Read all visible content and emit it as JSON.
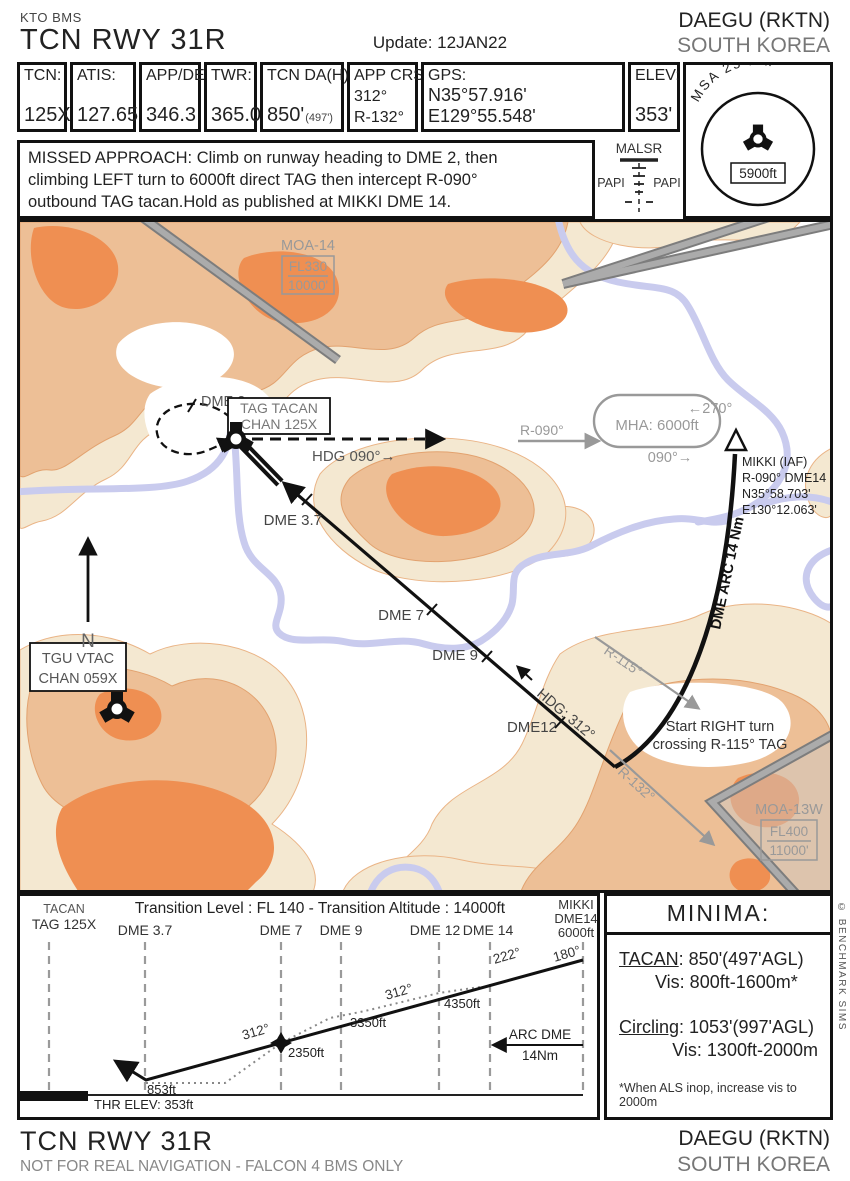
{
  "header": {
    "publisher": "KTO BMS",
    "title": "TCN RWY 31R",
    "update": "Update: 12JAN22",
    "airport": "DAEGU (RKTN)",
    "country": "SOUTH KOREA"
  },
  "databar": {
    "cells": [
      {
        "label": "TCN:",
        "value": "125X"
      },
      {
        "label": "ATIS:",
        "value": "127.65"
      },
      {
        "label": "APP/DEP:",
        "value": "346.3"
      },
      {
        "label": "TWR:",
        "value": "365.0"
      },
      {
        "label": "TCN DA(H):",
        "value": "850'",
        "value_note": "(497')"
      },
      {
        "label": "APP CRS:",
        "line2": "312°",
        "line3": "R-132°"
      },
      {
        "label": "GPS:",
        "line2": "N35°57.916'",
        "line3": "E129°55.548'"
      },
      {
        "label": "ELEV:",
        "value": "353'"
      }
    ]
  },
  "missed_approach": {
    "line1": "MISSED APPROACH: Climb on runway heading to DME 2, then",
    "line2": "climbing LEFT turn to 6000ft direct TAG then intercept R-090°",
    "line3": "outbound TAG tacan.Hold as published at MIKKI DME 14."
  },
  "lighting": {
    "title": "MALSR",
    "papi_left": "PAPI",
    "papi_right": "PAPI"
  },
  "msa": {
    "arc_label": "MSA 25 Nm",
    "altitude": "5900ft"
  },
  "map": {
    "moa14": {
      "name": "MOA-14",
      "upper": "FL330",
      "lower": "10000'"
    },
    "moa13w": {
      "name": "MOA-13W",
      "upper": "FL400",
      "lower": "11000'"
    },
    "dme2": "DME 2",
    "tag_tacan": {
      "line1": "TAG TACAN",
      "line2": "CHAN 125X"
    },
    "hdg090": "HDG 090°→",
    "hdg312": "HDG: 312°",
    "fix_37": "DME 3.7",
    "fix_7": "DME 7",
    "fix_9": "DME 9",
    "fix_12": "DME12",
    "arc_label": "DME ARC 14 Nm",
    "hold": {
      "top": "←270°",
      "mha": "MHA: 6000ft",
      "bottom": "090°→",
      "inbound": "R-090°"
    },
    "mikki": {
      "line1": "MIKKI (IAF)",
      "line2": "R-090° DME14",
      "line3": "N35°58.703'",
      "line4": "E130°12.063'"
    },
    "r115": "R-115°",
    "r132": "R-132°",
    "right_turn": {
      "line1": "Start RIGHT turn",
      "line2": "crossing R-115° TAG"
    },
    "tgu": {
      "line1": "TGU VTAC",
      "line2": "CHAN 059X"
    },
    "north": "N"
  },
  "profile": {
    "tacan_line1": "TACAN",
    "tacan_line2": "TAG 125X",
    "transition": "Transition Level : FL 140  -  Transition Altitude : 14000ft",
    "fixes": [
      "DME 3.7",
      "DME 7",
      "DME 9",
      "DME 12",
      "DME 14"
    ],
    "mikki_line1": "MIKKI",
    "mikki_line2": "DME14",
    "mikki_line3": "6000ft",
    "crs_180": "180°",
    "crs_222": "222°",
    "crs_312_upper": "312°",
    "crs_312_lower": "312°",
    "alt_853": "853ft",
    "alt_2350": "2350ft",
    "alt_3350": "3350ft",
    "alt_4350": "4350ft",
    "arc_line1": "ARC DME",
    "arc_line2": "14Nm",
    "thr_elev": "THR ELEV: 353ft"
  },
  "minima": {
    "title": "MINIMA:",
    "tacan_label": "TACAN",
    "tacan_value": ": 850'(497'AGL)",
    "tacan_vis": "Vis: 800ft-1600m*",
    "circling_label": "Circling",
    "circling_value": ": 1053'(997'AGL)",
    "circling_vis": "Vis: 1300ft-2000m",
    "note": "*When ALS inop, increase vis to 2000m"
  },
  "copyright": "© BENCHMARK SIMS",
  "footer": {
    "title": "TCN RWY 31R",
    "subtitle": "NOT FOR REAL NAVIGATION - FALCON 4 BMS ONLY",
    "airport": "DAEGU (RKTN)",
    "country": "SOUTH KOREA"
  },
  "colors": {
    "ink": "#111111",
    "gray_label": "#999999",
    "terrain_cream": "#f4e8d1",
    "terrain_tan": "#edbf96",
    "terrain_orange": "#ef8f52",
    "river": "#c9cbee",
    "road": "#8f8f8f"
  }
}
